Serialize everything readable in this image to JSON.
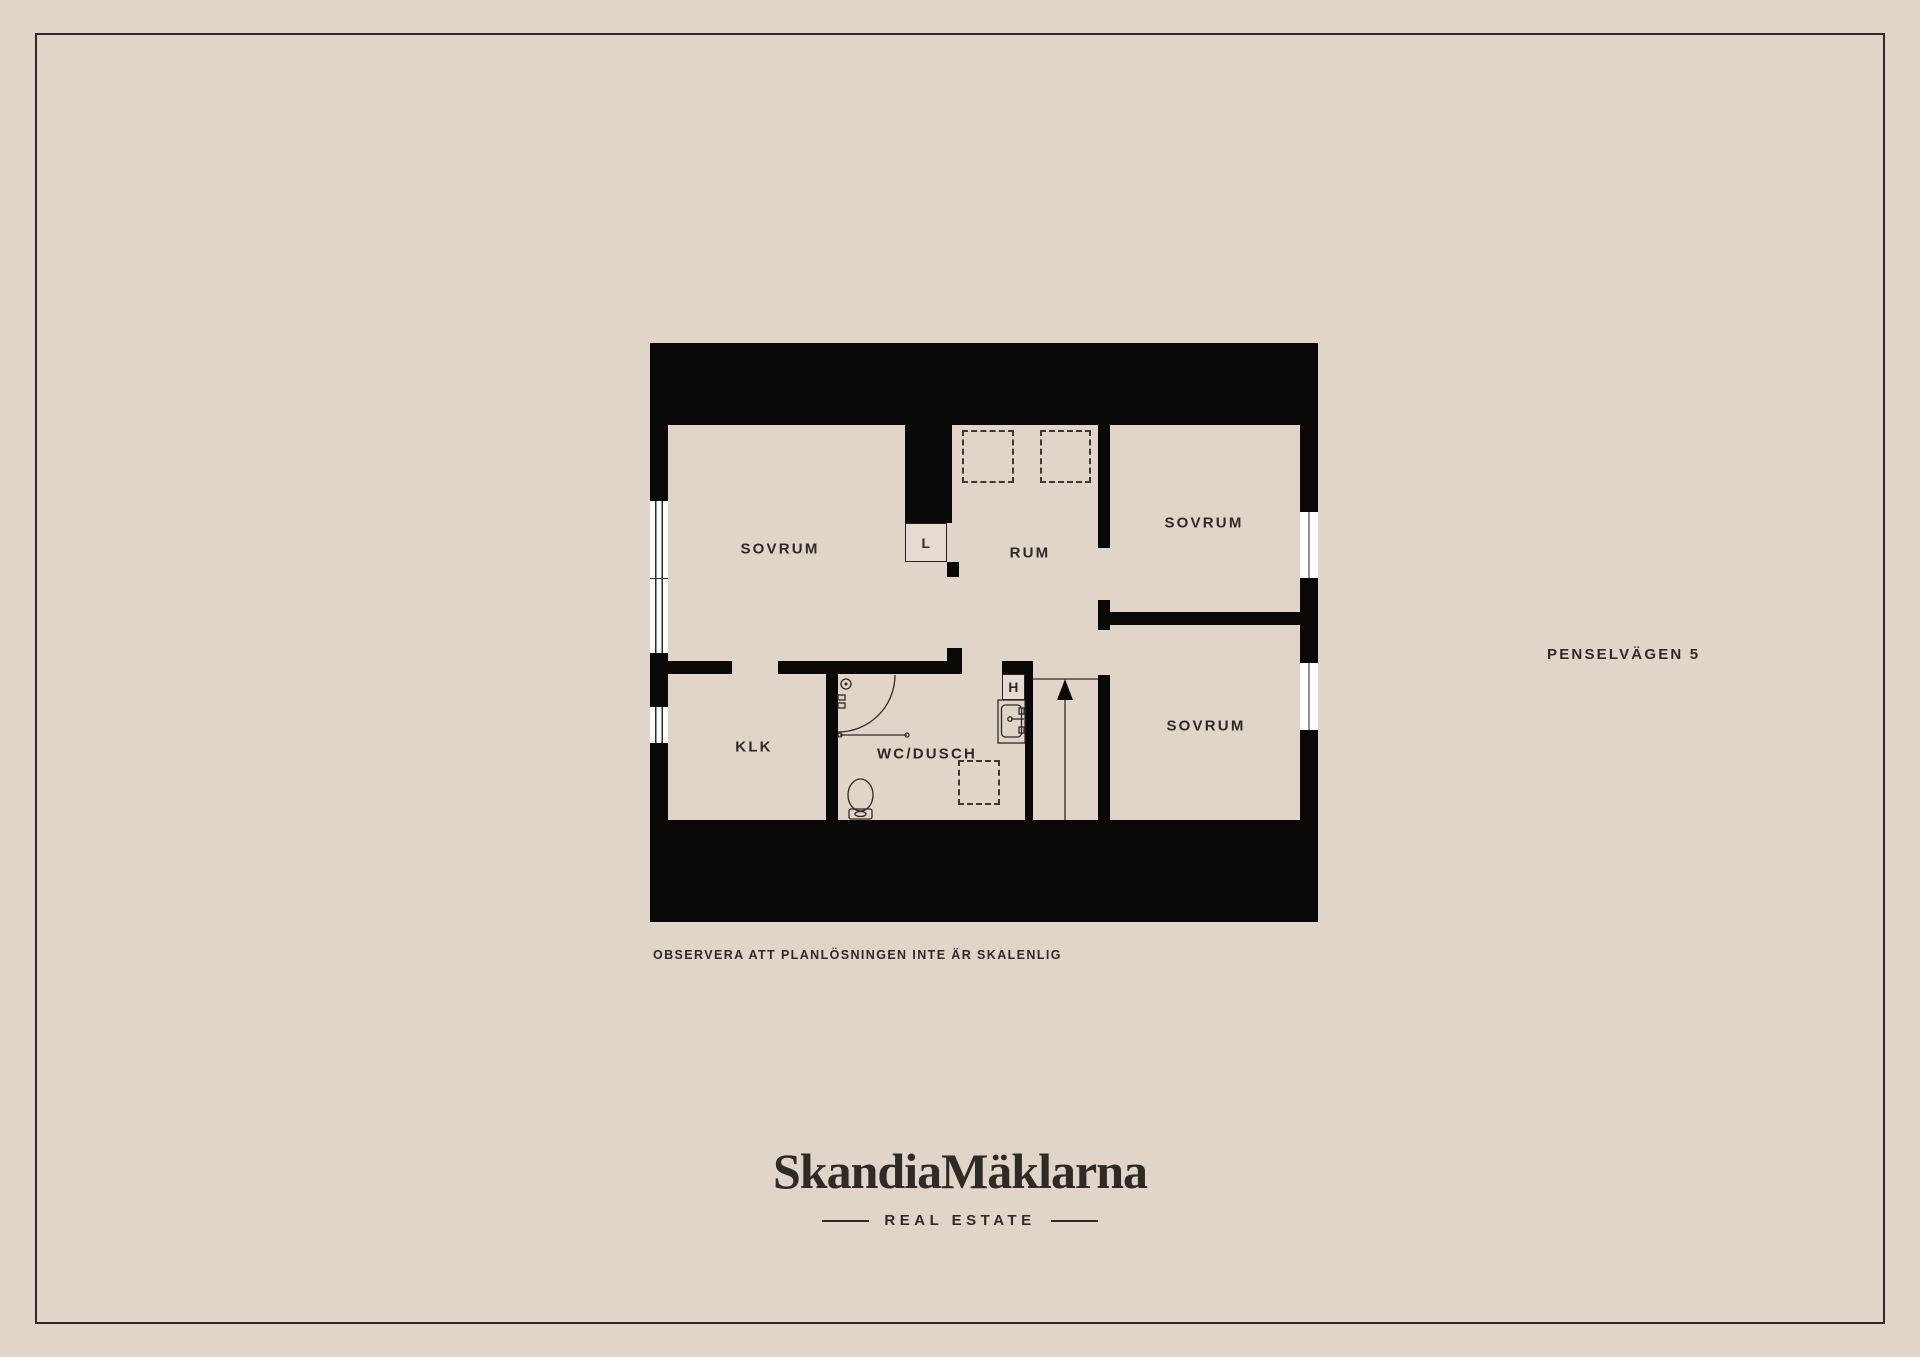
{
  "page": {
    "address": "PENSELVÄGEN 5",
    "disclaimer": "OBSERVERA ATT PLANLÖSNINGEN INTE ÄR SKALENLIG"
  },
  "plan": {
    "rooms": [
      {
        "id": "sovrum-nw",
        "label": "SOVRUM"
      },
      {
        "id": "rum",
        "label": "RUM"
      },
      {
        "id": "sovrum-ne",
        "label": "SOVRUM"
      },
      {
        "id": "sovrum-se",
        "label": "SOVRUM"
      },
      {
        "id": "klk",
        "label": "KLK"
      },
      {
        "id": "wc-dusch",
        "label": "WC/DUSCH"
      }
    ],
    "markers": [
      {
        "id": "closet",
        "label": "L"
      },
      {
        "id": "hall",
        "label": "H"
      }
    ]
  },
  "branding": {
    "logo": "SkandiaMäklarna",
    "tagline": "REAL ESTATE"
  },
  "colors": {
    "background": "#e1d5c9",
    "wall": "#0a0807",
    "text": "#2e2b26",
    "window": "#ffffff"
  }
}
